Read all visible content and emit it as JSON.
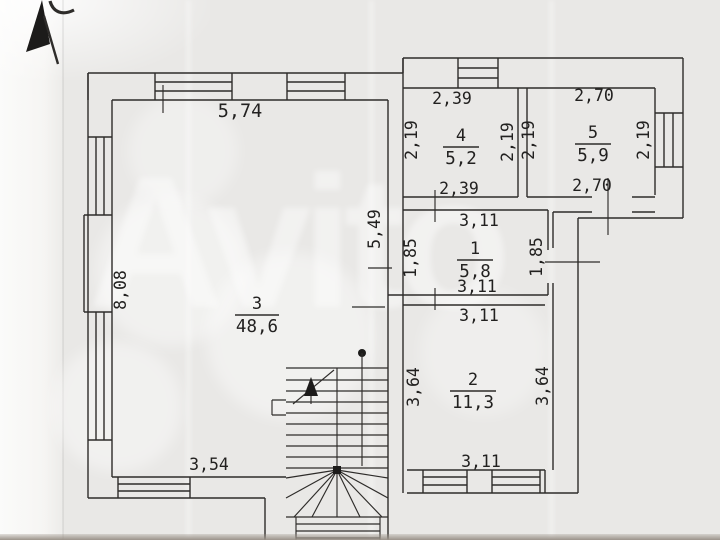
{
  "watermark": {
    "text": "Avito"
  },
  "rooms": {
    "r1": {
      "number": "1",
      "area": "5,8"
    },
    "r2": {
      "number": "2",
      "area": "11,3"
    },
    "r3": {
      "number": "3",
      "area": "48,6"
    },
    "r4": {
      "number": "4",
      "area": "5,2"
    },
    "r5": {
      "number": "5",
      "area": "5,9"
    }
  },
  "dims": {
    "room3_top": "5,74",
    "room3_left": "8,08",
    "room3_bottom": "3,54",
    "hall_left": "5,49",
    "room4_top": "2,39",
    "room4_bottom": "2,39",
    "room4_left": "2,19",
    "room4_right": "2,19",
    "room5_top": "2,70",
    "room5_bottom": "2,70",
    "room5_left": "2,19",
    "room5_right": "2,19",
    "room1_top": "3,11",
    "room1_bottom": "3,11",
    "room1_left": "1,85",
    "room1_right": "1,85",
    "room2_top": "3,11",
    "room2_bottom": "3,11",
    "room2_left": "3,64",
    "room2_right": "3,64"
  }
}
